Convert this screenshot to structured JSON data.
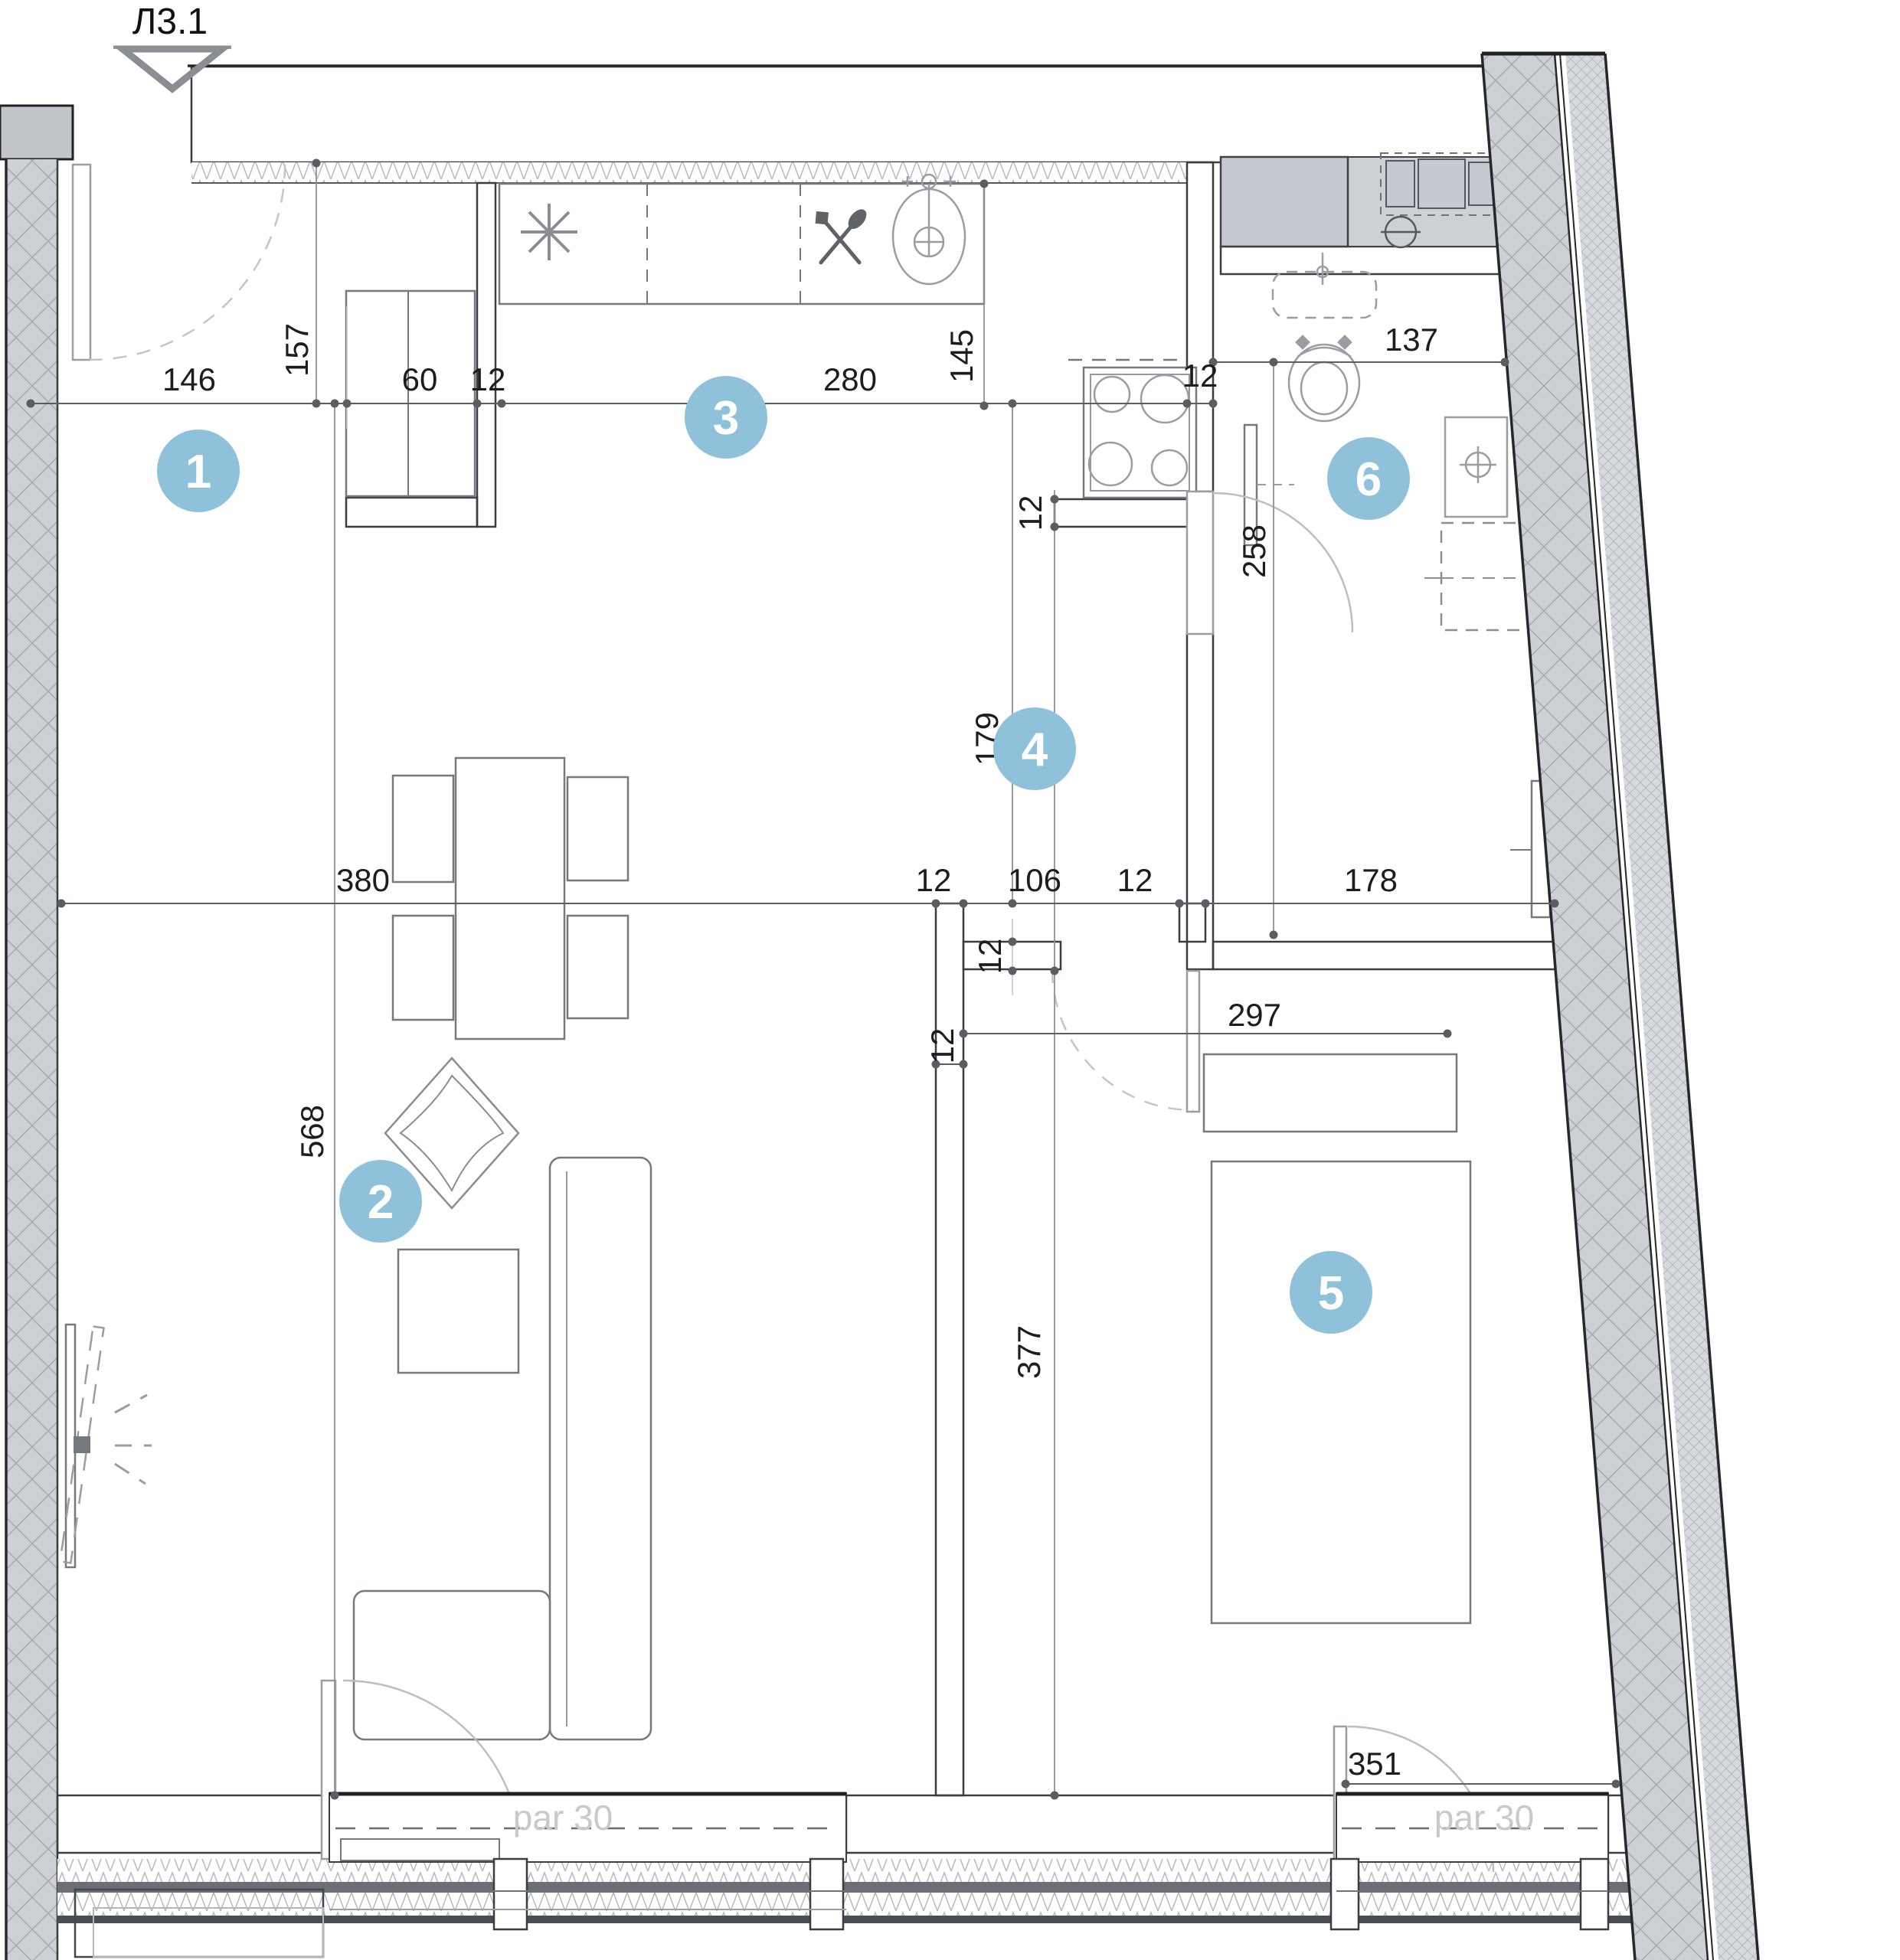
{
  "drawing": {
    "entry_marker": "Л3.1",
    "par30": "par 30"
  },
  "colors": {
    "badge": "#8fc2da",
    "badge_text": "#ffffff",
    "wall_fill": "#c9cdd2",
    "dim_color": "#5a5d61"
  },
  "rooms": [
    "1",
    "2",
    "3",
    "4",
    "5",
    "6"
  ],
  "dims": {
    "d146": "146",
    "d157": "157",
    "d60": "60",
    "d12": "12",
    "d280": "280",
    "d145": "145",
    "d137": "137",
    "d258": "258",
    "d179": "179",
    "d106": "106",
    "d178": "178",
    "d380": "380",
    "d568": "568",
    "d297": "297",
    "d377": "377",
    "d351": "351"
  },
  "icons": {
    "star": "star-symbol",
    "cutlery": "cutlery-icon",
    "sink": "sink-icon",
    "stove": "stove-icon",
    "toilet": "toilet-icon",
    "washer": "washing-machine",
    "vent": "vent-icon",
    "tv": "tv-icon"
  }
}
